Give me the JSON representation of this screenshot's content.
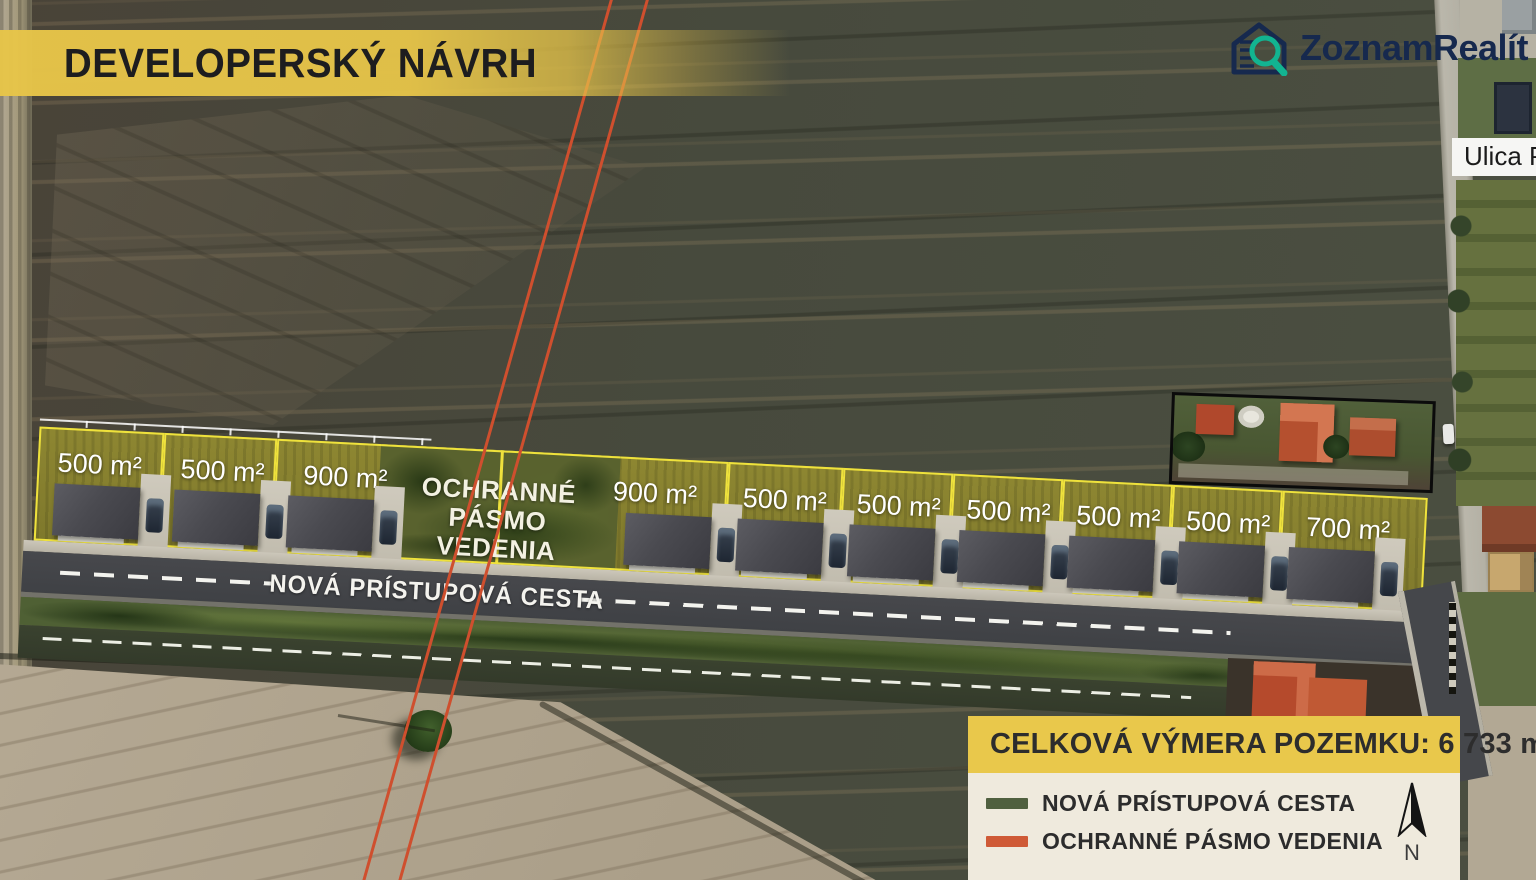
{
  "title": "DEVELOPERSKÝ NÁVRH",
  "logo": {
    "brand": "ZoznamRealít",
    "suffix": "SK",
    "brand_color": "#16294e",
    "suffix_color": "#11b28f"
  },
  "street_sign": "Ulica Pr",
  "road_label": "NOVÁ PRÍSTUPOVÁ CESTA",
  "zone_label_line1": "OCHRANNÉ PÁSMO",
  "zone_label_line2": "VEDENIA",
  "plots": [
    {
      "area": "500 m²",
      "x": 10,
      "w": 125,
      "label_cx": 72,
      "house_x": 28
    },
    {
      "area": "500 m²",
      "x": 135,
      "w": 113,
      "label_cx": 195,
      "house_x": 148
    },
    {
      "area": "900 m²",
      "x": 248,
      "w": 227,
      "label_cx": 318,
      "house_x": 262
    },
    {
      "area": "900 m²",
      "x": 475,
      "w": 225,
      "label_cx": 628,
      "house_x": 600
    },
    {
      "area": "500 m²",
      "x": 700,
      "w": 115,
      "label_cx": 758,
      "house_x": 712
    },
    {
      "area": "500 m²",
      "x": 815,
      "w": 110,
      "label_cx": 872,
      "house_x": 824
    },
    {
      "area": "500 m²",
      "x": 925,
      "w": 110,
      "label_cx": 982,
      "house_x": 934
    },
    {
      "area": "500 m²",
      "x": 1035,
      "w": 110,
      "label_cx": 1092,
      "house_x": 1044
    },
    {
      "area": "500 m²",
      "x": 1145,
      "w": 110,
      "label_cx": 1202,
      "house_x": 1154
    },
    {
      "area": "700 m²",
      "x": 1255,
      "w": 145,
      "label_cx": 1322,
      "house_x": 1264
    }
  ],
  "legend": {
    "header": "CELKOVÁ VÝMERA POZEMKU: 6 733 m²",
    "items": [
      {
        "label": "NOVÁ PRÍSTUPOVÁ CESTA",
        "color": "#50603f"
      },
      {
        "label": "OCHRANNÉ PÁSMO VEDENIA",
        "color": "#cf5a36"
      }
    ],
    "north_label": "N"
  },
  "colors": {
    "plot_border": "#efe23c",
    "protective_line": "#cf4f2e",
    "banner": "#e7c549",
    "legend_header_bg": "#e9c84b",
    "legend_body_bg": "#efeadd"
  }
}
